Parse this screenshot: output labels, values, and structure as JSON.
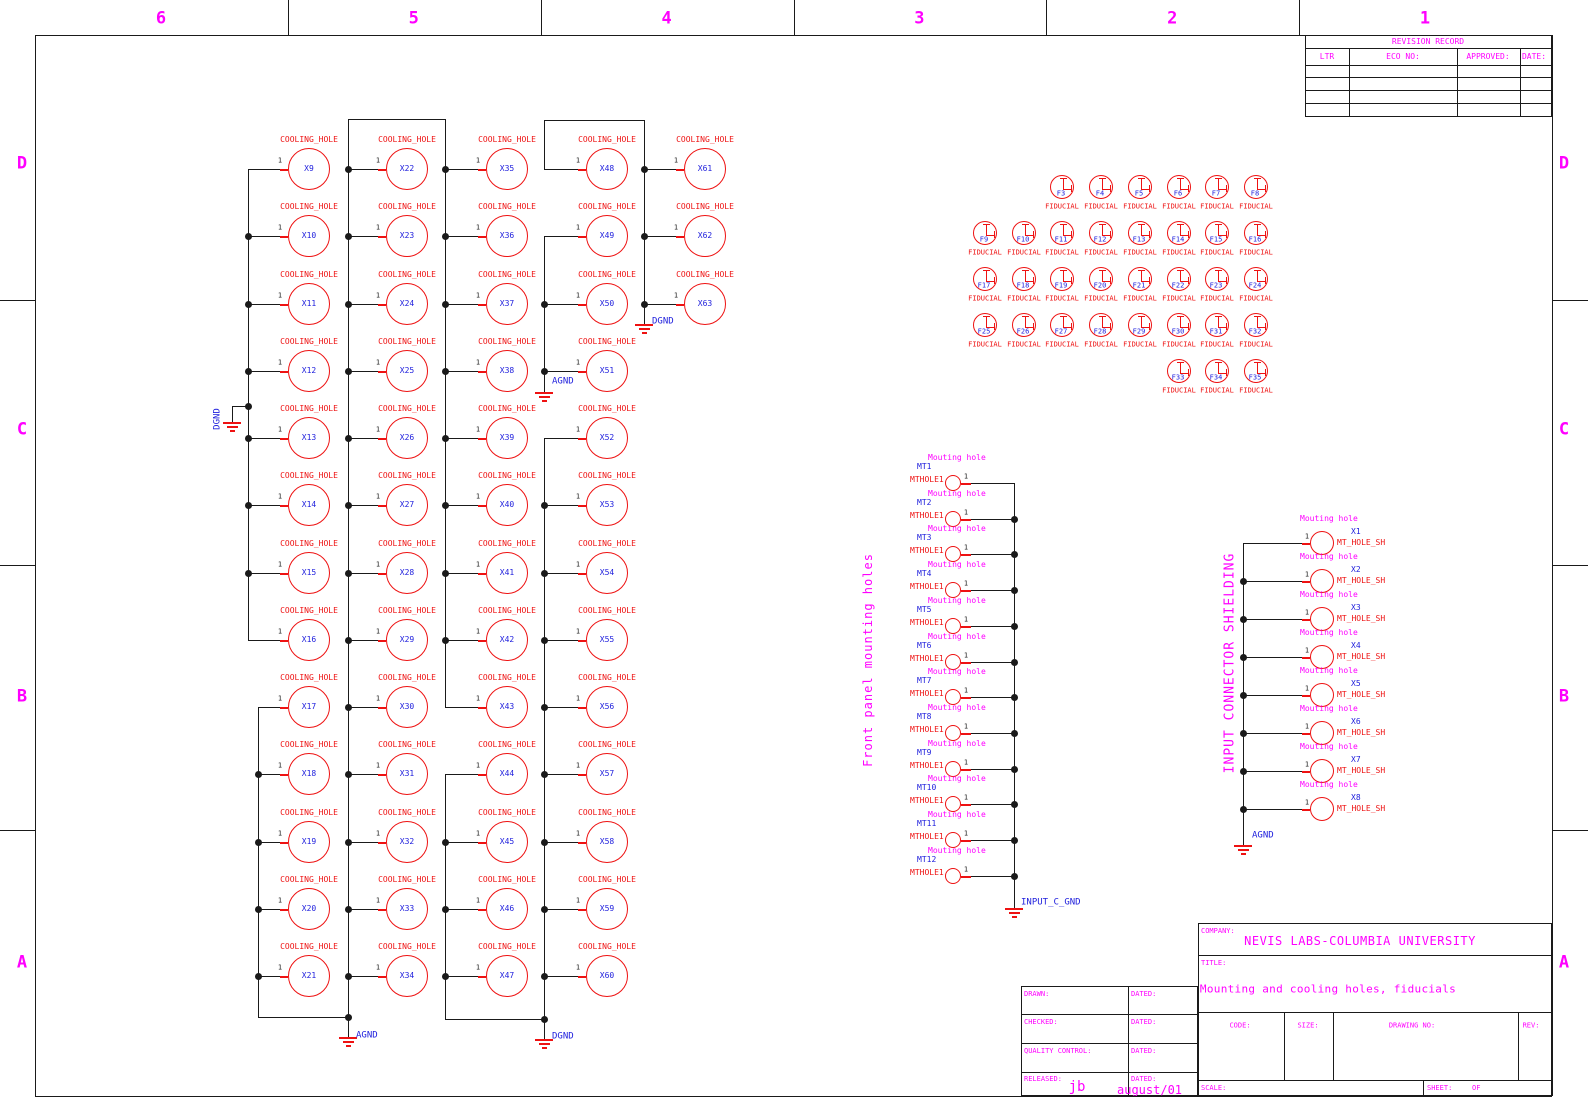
{
  "colors": {
    "red": "#ee1212",
    "blue": "#2121dd",
    "magenta": "#ff00ff",
    "wire": "#1a1a1a"
  },
  "zones": {
    "top_numbers": [
      "6",
      "5",
      "4",
      "3",
      "2",
      "1"
    ],
    "side_letters": [
      "D",
      "C",
      "B",
      "A"
    ]
  },
  "revision_table": {
    "title": "REVISION RECORD",
    "headers": [
      "LTR",
      "ECO NO:",
      "APPROVED:",
      "DATE:"
    ],
    "empty_rows": 4
  },
  "cooling": {
    "part_label": "COOLING_HOLE",
    "pin": "1",
    "columns": [
      {
        "refs": [
          "X9",
          "X10",
          "X11",
          "X12",
          "X13",
          "X14",
          "X15",
          "X16",
          "X17",
          "X18",
          "X19",
          "X20",
          "X21"
        ]
      },
      {
        "refs": [
          "X22",
          "X23",
          "X24",
          "X25",
          "X26",
          "X27",
          "X28",
          "X29",
          "X30",
          "X31",
          "X32",
          "X33",
          "X34"
        ]
      },
      {
        "refs": [
          "X35",
          "X36",
          "X37",
          "X38",
          "X39",
          "X40",
          "X41",
          "X42",
          "X43",
          "X44",
          "X45",
          "X46",
          "X47"
        ]
      },
      {
        "refs": [
          "X48",
          "X49",
          "X50",
          "X51",
          "X52",
          "X53",
          "X54",
          "X55",
          "X56",
          "X57",
          "X58",
          "X59",
          "X60"
        ]
      },
      {
        "refs": [
          "X61",
          "X62",
          "X63"
        ]
      }
    ],
    "ground_nets": {
      "col0_tap": "DGND",
      "col1_bottom": "AGND",
      "col3_mid": "AGND",
      "col3_bottom": "DGND",
      "col4_bottom": "DGND"
    }
  },
  "fiducials": {
    "part_label": "FIDUCIAL",
    "rows": [
      {
        "start_col": 2,
        "refs": [
          "F3",
          "F4",
          "F5",
          "F6",
          "F7",
          "F8"
        ]
      },
      {
        "start_col": 0,
        "refs": [
          "F9",
          "F10",
          "F11",
          "F12",
          "F13",
          "F14",
          "F15",
          "F16"
        ]
      },
      {
        "start_col": 0,
        "refs": [
          "F17",
          "F18",
          "F19",
          "F20",
          "F21",
          "F22",
          "F23",
          "F24"
        ]
      },
      {
        "start_col": 0,
        "refs": [
          "F25",
          "F26",
          "F27",
          "F28",
          "F29",
          "F30",
          "F31",
          "F32"
        ]
      },
      {
        "start_col": 5,
        "refs": [
          "F33",
          "F34",
          "F35"
        ]
      }
    ]
  },
  "front_panel": {
    "section_title": "Front panel mounting holes",
    "instance_label": "Mouting hole",
    "part_label": "MTHOLE1",
    "pin": "1",
    "refs": [
      "MT1",
      "MT2",
      "MT3",
      "MT4",
      "MT5",
      "MT6",
      "MT7",
      "MT8",
      "MT9",
      "MT10",
      "MT11",
      "MT12"
    ],
    "ground_net": "INPUT_C_GND"
  },
  "input_shielding": {
    "section_title": "INPUT CONNECTOR SHIELDING",
    "instance_label": "Mouting hole",
    "part_label": "MT_HOLE_SH",
    "pin": "1",
    "refs": [
      "X1",
      "X2",
      "X3",
      "X4",
      "X5",
      "X6",
      "X7",
      "X8"
    ],
    "ground_net": "AGND"
  },
  "title_block": {
    "company_label": "COMPANY:",
    "company": "NEVIS LABS-COLUMBIA UNIVERSITY",
    "title_label": "TITLE:",
    "title": "Mounting and cooling holes, fiducials",
    "code_label": "CODE:",
    "size_label": "SIZE:",
    "drawing_no_label": "DRAWING NO:",
    "rev_label": "REV:",
    "scale_label": "SCALE:",
    "sheet_label": "SHEET:",
    "of_label": "OF",
    "approvals": [
      {
        "label": "DRAWN:",
        "dated_label": "DATED:",
        "name": "",
        "date": ""
      },
      {
        "label": "CHECKED:",
        "dated_label": "DATED:",
        "name": "",
        "date": ""
      },
      {
        "label": "QUALITY CONTROL:",
        "dated_label": "DATED:",
        "name": "",
        "date": ""
      },
      {
        "label": "RELEASED:",
        "dated_label": "DATED:",
        "name": "jb",
        "date": "august/01"
      }
    ]
  }
}
